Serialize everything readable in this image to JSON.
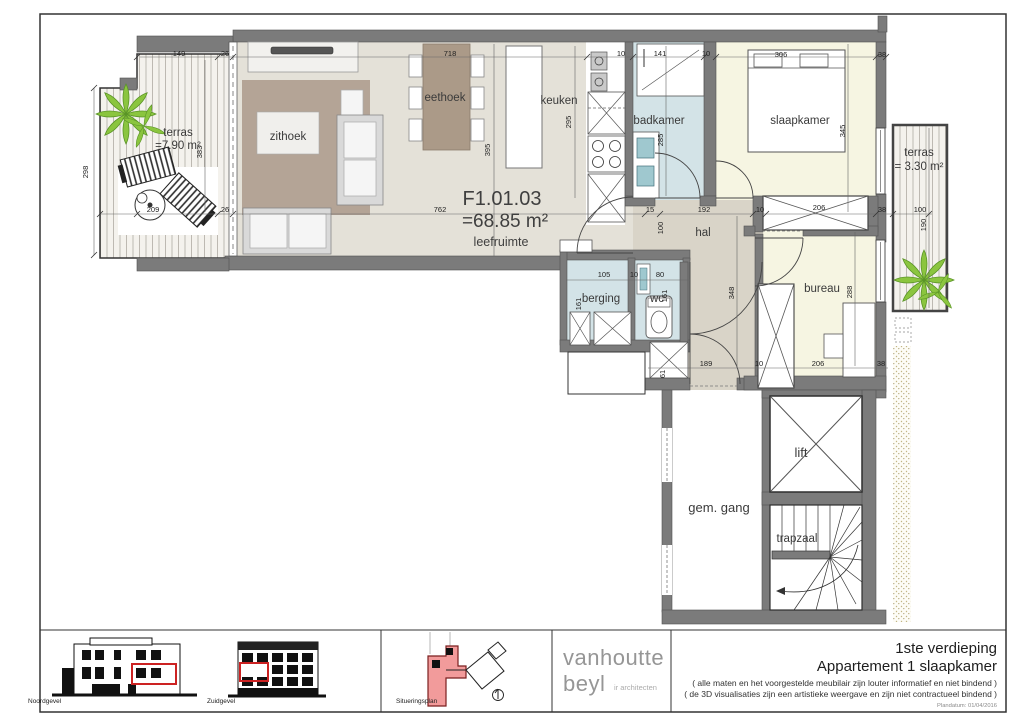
{
  "plan": {
    "code": "F1.01.03",
    "area": "=68.85 m²",
    "area_room": "leefruimte"
  },
  "room_labels": [
    {
      "t": "terras",
      "x": 178,
      "y": 136
    },
    {
      "t": "=7.90 m²",
      "x": 178,
      "y": 149
    },
    {
      "t": "zithoek",
      "x": 288,
      "y": 140
    },
    {
      "t": "eethoek",
      "x": 445,
      "y": 101
    },
    {
      "t": "keuken",
      "x": 559,
      "y": 104
    },
    {
      "t": "badkamer",
      "x": 659,
      "y": 124
    },
    {
      "t": "slaapkamer",
      "x": 800,
      "y": 124
    },
    {
      "t": "terras",
      "x": 919,
      "y": 156
    },
    {
      "t": "= 3.30 m²",
      "x": 919,
      "y": 170
    },
    {
      "t": "hal",
      "x": 703,
      "y": 236
    },
    {
      "t": "berging",
      "x": 601,
      "y": 302
    },
    {
      "t": "wc",
      "x": 657,
      "y": 302
    },
    {
      "t": "bureau",
      "x": 822,
      "y": 292
    },
    {
      "t": "gem. gang",
      "x": 719,
      "y": 512,
      "s": "lg"
    },
    {
      "t": "lift",
      "x": 801,
      "y": 457,
      "s": "lg"
    },
    {
      "t": "trapzaal",
      "x": 797,
      "y": 542
    }
  ],
  "dims": [
    {
      "t": "149",
      "x": 179,
      "y": 56
    },
    {
      "t": "26",
      "x": 225,
      "y": 56
    },
    {
      "t": "718",
      "x": 450,
      "y": 56
    },
    {
      "t": "10",
      "x": 621,
      "y": 56
    },
    {
      "t": "141",
      "x": 660,
      "y": 56
    },
    {
      "t": "10",
      "x": 706,
      "y": 56
    },
    {
      "t": "306",
      "x": 781,
      "y": 57
    },
    {
      "t": "38",
      "x": 882,
      "y": 57
    },
    {
      "t": "209",
      "x": 153,
      "y": 212
    },
    {
      "t": "26",
      "x": 225,
      "y": 212
    },
    {
      "t": "762",
      "x": 440,
      "y": 212
    },
    {
      "t": "15",
      "x": 650,
      "y": 212
    },
    {
      "t": "192",
      "x": 704,
      "y": 212
    },
    {
      "t": "10",
      "x": 760,
      "y": 212
    },
    {
      "t": "206",
      "x": 819,
      "y": 210
    },
    {
      "t": "38",
      "x": 882,
      "y": 212
    },
    {
      "t": "100",
      "x": 920,
      "y": 212
    },
    {
      "t": "105",
      "x": 604,
      "y": 277
    },
    {
      "t": "10",
      "x": 634,
      "y": 277
    },
    {
      "t": "80",
      "x": 660,
      "y": 277
    },
    {
      "t": "189",
      "x": 706,
      "y": 366
    },
    {
      "t": "10",
      "x": 759,
      "y": 366
    },
    {
      "t": "206",
      "x": 818,
      "y": 366
    },
    {
      "t": "38",
      "x": 881,
      "y": 366
    },
    {
      "t": "298",
      "x": 88,
      "y": 172,
      "r": 1
    },
    {
      "t": "383",
      "x": 202,
      "y": 152,
      "r": 1
    },
    {
      "t": "395",
      "x": 490,
      "y": 150,
      "r": 1
    },
    {
      "t": "295",
      "x": 571,
      "y": 122,
      "r": 1
    },
    {
      "t": "285",
      "x": 663,
      "y": 140,
      "r": 1
    },
    {
      "t": "345",
      "x": 845,
      "y": 131,
      "r": 1
    },
    {
      "t": "100",
      "x": 663,
      "y": 228,
      "r": 1
    },
    {
      "t": "348",
      "x": 734,
      "y": 293,
      "r": 1
    },
    {
      "t": "288",
      "x": 852,
      "y": 292,
      "r": 1
    },
    {
      "t": "161",
      "x": 581,
      "y": 304,
      "r": 1
    },
    {
      "t": "161",
      "x": 667,
      "y": 296,
      "r": 1
    },
    {
      "t": "190",
      "x": 926,
      "y": 225,
      "r": 1
    },
    {
      "t": "61",
      "x": 665,
      "y": 374,
      "r": 1
    }
  ],
  "titleblock": {
    "line1": "1ste verdieping",
    "line2": "Appartement 1 slaapkamer",
    "note1": "( alle maten en het voorgestelde meubilair zijn louter informatief en niet bindend )",
    "note2": "( de 3D visualisaties zijn een artistieke weergave en zijn niet contractueel bindend )",
    "plandate": "Plandatum: 01/04/2016"
  },
  "logo": {
    "name1": "vanhoutte",
    "name2": "beyl",
    "sub": "ir architecten"
  },
  "footer": {
    "noord": "Noordgevel",
    "zuid": "Zuidgevel",
    "situ": "Situeringsplan"
  },
  "colors": {
    "wall": "#7b7b7b",
    "floor_living": "#e4e1d8",
    "floor_hal": "#d9d4c8",
    "floor_bath": "#d3e3e7",
    "floor_bed": "#f6f5e2",
    "rug": "#b4a496",
    "wood": "#ab9a88",
    "fixture": "#9fc8cf",
    "deck_line": "#b7b3ab",
    "sand": "#c2b584",
    "accent_red": "#cc2222",
    "plant_green": "#8bc53f",
    "logo_gray": "#969696"
  }
}
